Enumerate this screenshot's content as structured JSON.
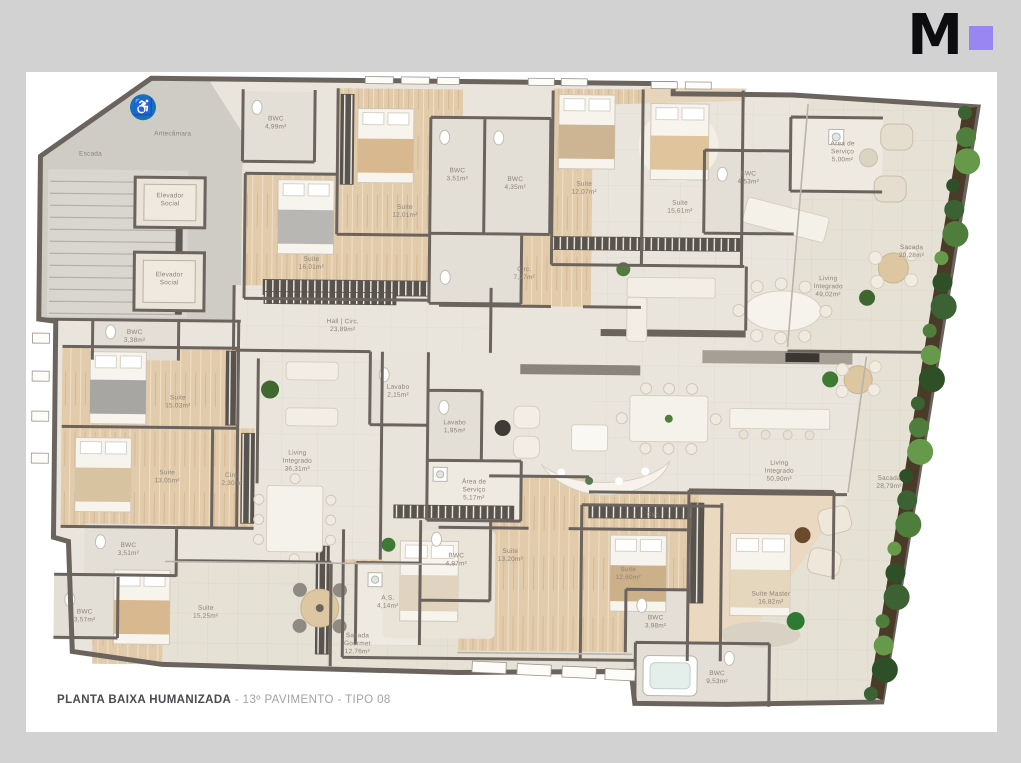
{
  "brand": {
    "letter": "M",
    "accent_color": "#9a86f2"
  },
  "caption": {
    "title": "PLANTA BAIXA HUMANIZADA",
    "subtitle": " - 13º PAVIMENTO - TIPO 08"
  },
  "accessibility_icon": {
    "glyph": "♿",
    "color": "#1273b5"
  },
  "colors": {
    "background": "#d2d2d2",
    "paper": "#ffffff",
    "wall": "#6b645e",
    "wood_floor": "#e2cbab",
    "tile_floor": "#eae5dc",
    "balcony_floor": "#e6e1d6",
    "plant_green": "#4f7d3c",
    "label_text": "#8d8378"
  },
  "rooms": [
    {
      "id": "escada",
      "name": "Escada",
      "area": ""
    },
    {
      "id": "antecamara",
      "name": "Antecâmara",
      "area": ""
    },
    {
      "id": "elevador-social-1",
      "name": "Elevador Social",
      "area": ""
    },
    {
      "id": "elevador-social-2",
      "name": "Elevador Social",
      "area": ""
    },
    {
      "id": "bwc-4-99",
      "name": "BWC",
      "area": "4,99m²"
    },
    {
      "id": "suite-12-01",
      "name": "Suite",
      "area": "12,01m²"
    },
    {
      "id": "bwc-3-51-a",
      "name": "BWC",
      "area": "3,51m²"
    },
    {
      "id": "bwc-4-35",
      "name": "BWC",
      "area": "4,35m²"
    },
    {
      "id": "suite-12-07",
      "name": "Suite",
      "area": "12,07m²"
    },
    {
      "id": "suite-16-01",
      "name": "Suite",
      "area": "16,01m²"
    },
    {
      "id": "circ-7-27",
      "name": "Circ.",
      "area": "7,27m²"
    },
    {
      "id": "suite-15-61",
      "name": "Suite",
      "area": "15,61m²"
    },
    {
      "id": "bwc-4-53",
      "name": "BWC",
      "area": "4,53m²"
    },
    {
      "id": "area-servico-5-00",
      "name": "Área de Serviço",
      "area": "5,00m²"
    },
    {
      "id": "sacada-20-28",
      "name": "Sacada",
      "area": "20,28m²"
    },
    {
      "id": "living-integrado-49-02",
      "name": "Living Integrado",
      "area": "49,02m²"
    },
    {
      "id": "hall-circ-23-89",
      "name": "Hall | Circ.",
      "area": "23,89m²"
    },
    {
      "id": "bwc-3-38",
      "name": "BWC",
      "area": "3,38m²"
    },
    {
      "id": "suite-15-03",
      "name": "Suite",
      "area": "15,03m²"
    },
    {
      "id": "suite-13-05",
      "name": "Suite",
      "area": "13,05m²"
    },
    {
      "id": "circ-2-30",
      "name": "Circ.",
      "area": "2,30m²"
    },
    {
      "id": "living-integrado-36-31",
      "name": "Living Integrado",
      "area": "36,31m²"
    },
    {
      "id": "lavabo-2-15",
      "name": "Lavabo",
      "area": "2,15m²"
    },
    {
      "id": "lavabo-1-95",
      "name": "Lavabo",
      "area": "1,95m²"
    },
    {
      "id": "area-servico-5-17",
      "name": "Área de Serviço",
      "area": "5,17m²"
    },
    {
      "id": "bwc-3-51-b",
      "name": "BWC",
      "area": "3,51m²"
    },
    {
      "id": "bwc-3-57",
      "name": "BWC",
      "area": "3,57m²"
    },
    {
      "id": "suite-15-25",
      "name": "Suite",
      "area": "15,25m²"
    },
    {
      "id": "as-4-14",
      "name": "A.S.",
      "area": "4,14m²"
    },
    {
      "id": "sacada-gourmet-12-76",
      "name": "Sacada Gourmet",
      "area": "12,76m²"
    },
    {
      "id": "living-integrado-50-90",
      "name": "Living Integrado",
      "area": "50,90m²"
    },
    {
      "id": "sacada-28-79",
      "name": "Sacada",
      "area": "28,79m²"
    },
    {
      "id": "bwc-4-97",
      "name": "BWC",
      "area": "4,97m²"
    },
    {
      "id": "suite-13-20",
      "name": "Suite",
      "area": "13,20m²"
    },
    {
      "id": "suite-12-60",
      "name": "Suite",
      "area": "12,60m²"
    },
    {
      "id": "circ-b",
      "name": "Circ.",
      "area": ""
    },
    {
      "id": "bwc-3-98",
      "name": "BWC",
      "area": "3,98m²"
    },
    {
      "id": "suite-master-16-82",
      "name": "Suite Master",
      "area": "16,82m²"
    },
    {
      "id": "bwc-9-53",
      "name": "BWC",
      "area": "9,53m²"
    }
  ]
}
